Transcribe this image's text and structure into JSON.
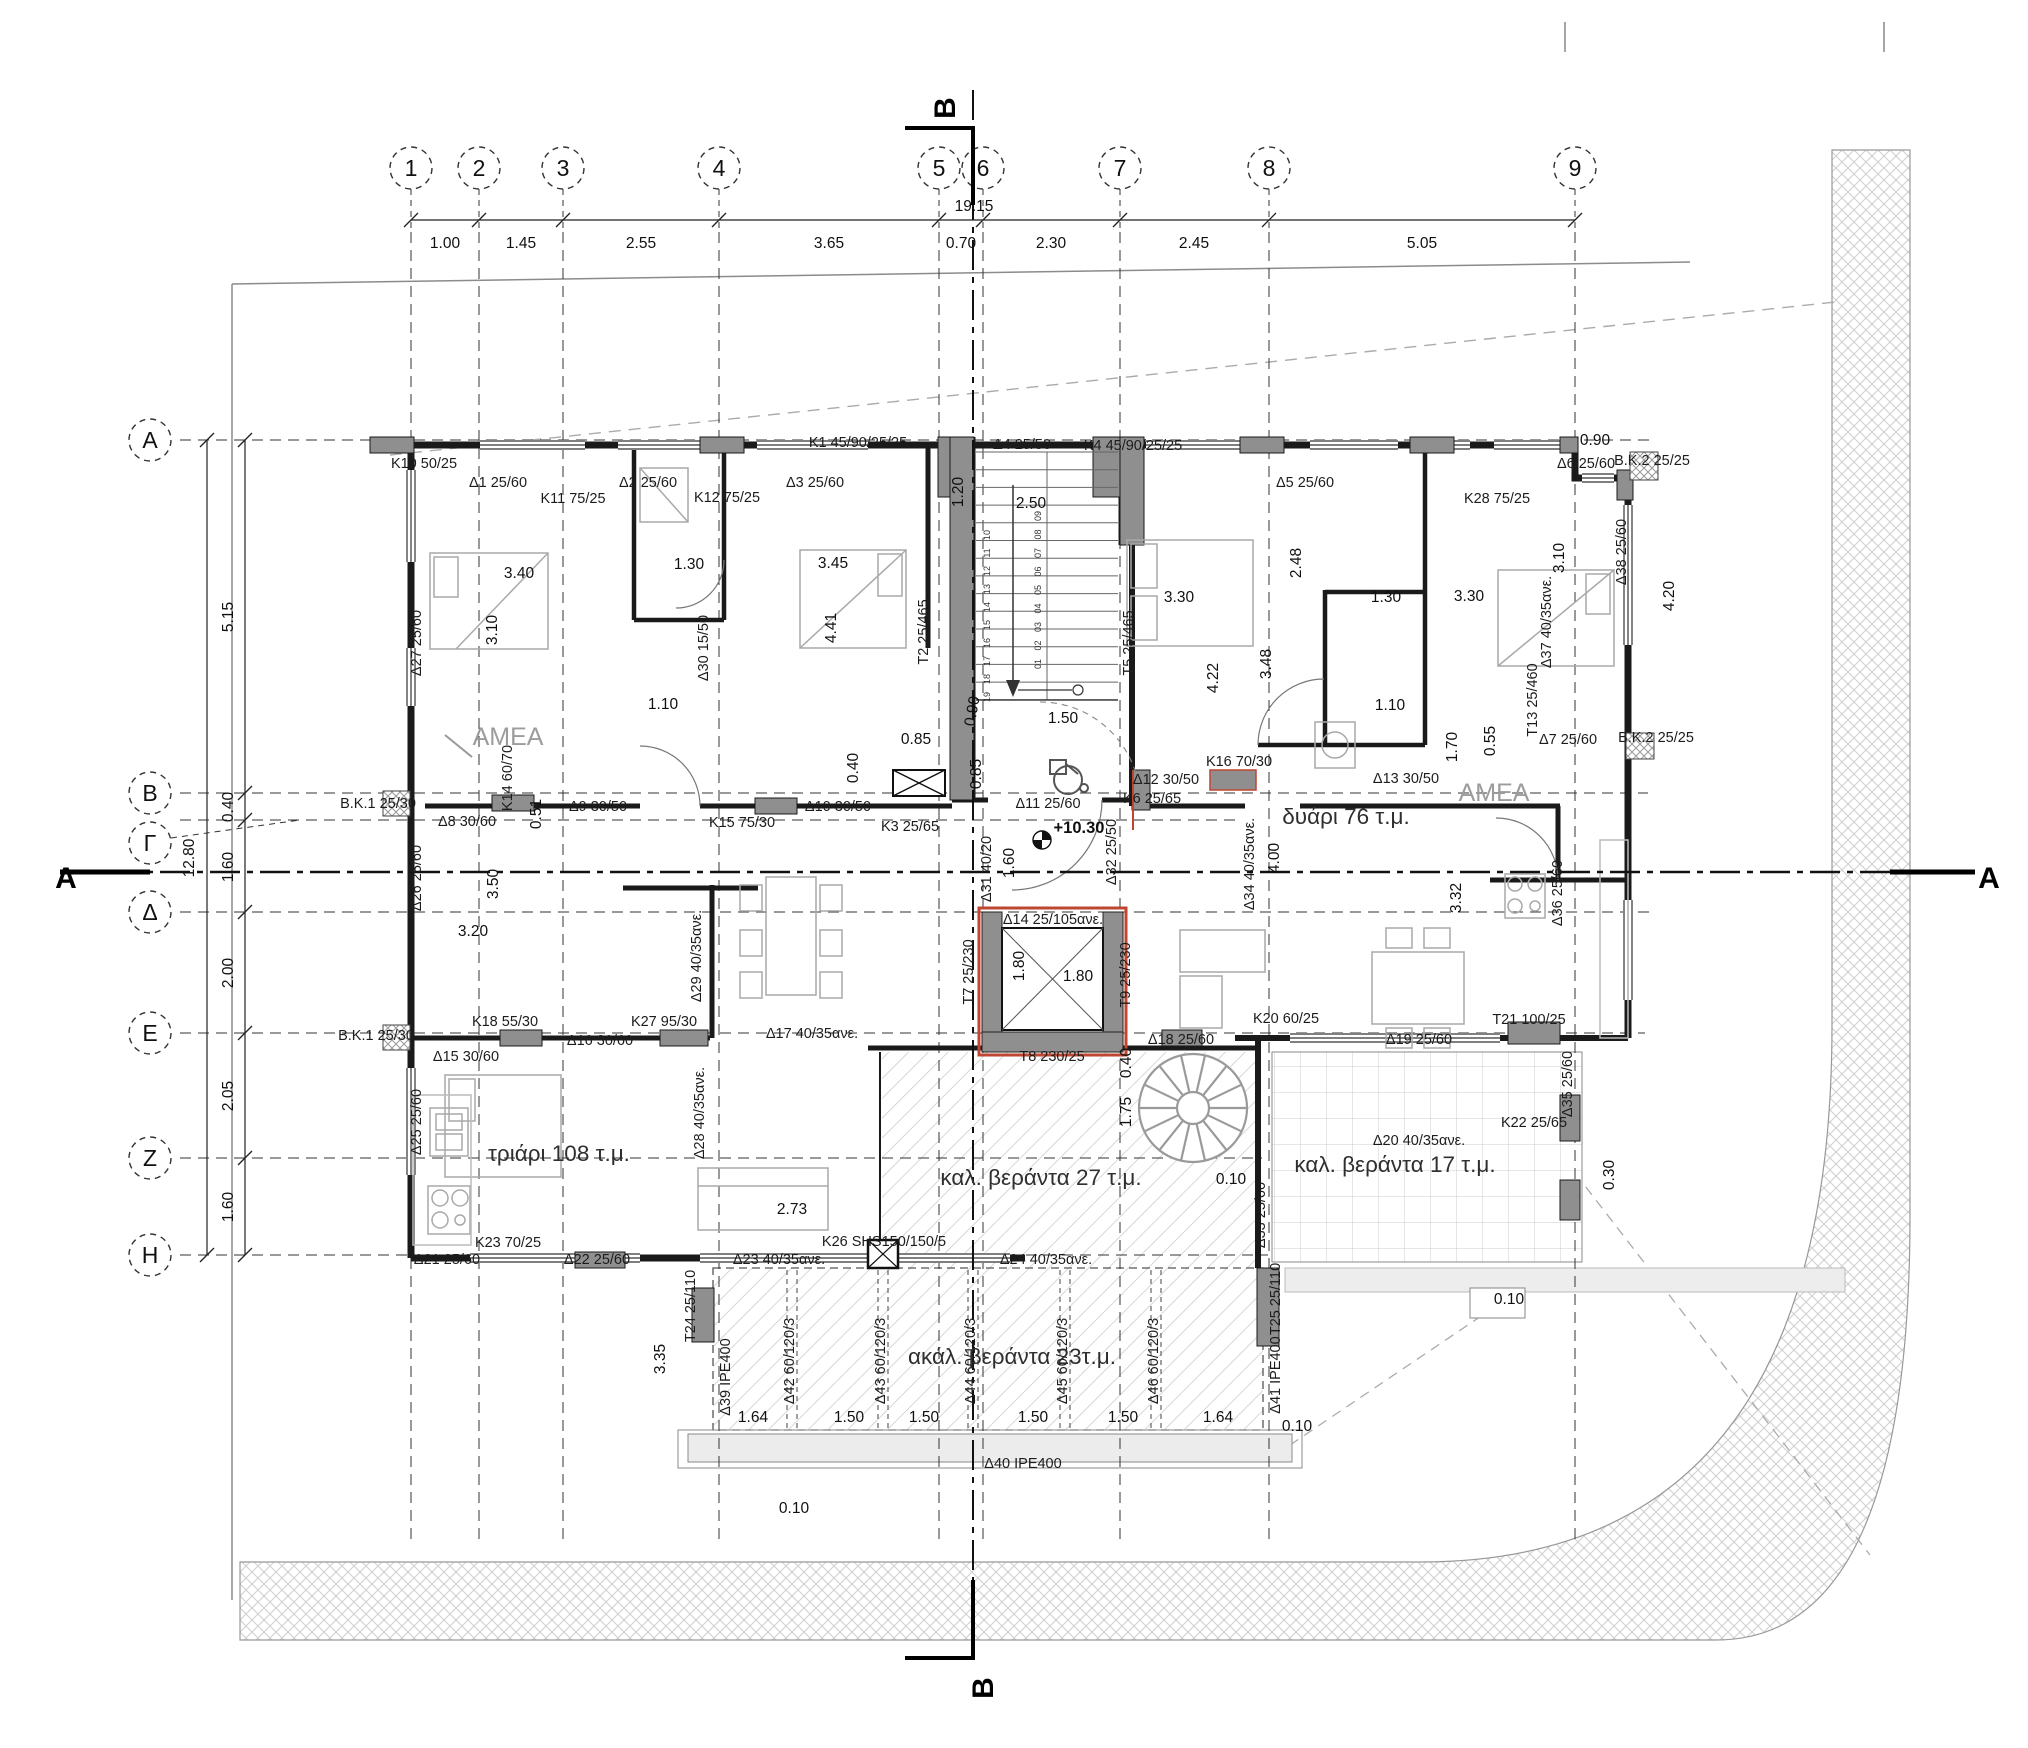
{
  "drawing": {
    "title": "Floor plan – apartment level",
    "level_elevation": "+10.30",
    "overall_width": "19.15",
    "overall_height": "12.80"
  },
  "colors": {
    "wall": "#1a1a1a",
    "column": "#8f8f8f",
    "accent_red": "#bf4630",
    "note_gray": "#9c9c9c",
    "hatch": "#c6c6c6"
  },
  "grid": {
    "columns": [
      [
        "1",
        411
      ],
      [
        "2",
        479
      ],
      [
        "3",
        563
      ],
      [
        "4",
        719
      ],
      [
        "5",
        939
      ],
      [
        "6",
        983
      ],
      [
        "7",
        1120
      ],
      [
        "8",
        1269
      ],
      [
        "9",
        1575
      ]
    ],
    "rows": [
      [
        "A",
        440
      ],
      [
        "B",
        793
      ],
      [
        "Γ",
        820
      ],
      [
        "Δ",
        912
      ],
      [
        "E",
        1033
      ],
      [
        "Z",
        1158
      ],
      [
        "H",
        1255
      ]
    ]
  },
  "stairs": {
    "left_numbers": [
      "10",
      "11",
      "12",
      "13",
      "14",
      "15",
      "16",
      "17",
      "18",
      "19"
    ],
    "right_numbers": [
      "09",
      "08",
      "07",
      "06",
      "05",
      "04",
      "03",
      "02",
      "01"
    ]
  },
  "labels": [
    [
      "K10 50/25",
      424,
      468,
      0,
      "b"
    ],
    [
      "Δ1 25/60",
      498,
      487,
      0,
      "b"
    ],
    [
      "K11 75/25",
      573,
      503,
      0,
      "b"
    ],
    [
      "Δ2 25/60",
      648,
      487,
      0,
      "b"
    ],
    [
      "K12 75/25",
      727,
      502,
      0,
      "b"
    ],
    [
      "Δ3 25/60",
      815,
      487,
      0,
      "b"
    ],
    [
      "K1 45/90/25/25",
      858,
      447,
      0,
      "b"
    ],
    [
      "Δ4 25/50",
      1022,
      449,
      0,
      "b"
    ],
    [
      "K4 45/90/25/25",
      1133,
      450,
      0,
      "b"
    ],
    [
      "Δ5 25/60",
      1305,
      487,
      0,
      "b"
    ],
    [
      "K28 75/25",
      1497,
      503,
      0,
      "b"
    ],
    [
      "Δ6 25/60",
      1586,
      468,
      0,
      "b"
    ],
    [
      "B.K.2 25/25",
      1652,
      465,
      0,
      "b"
    ],
    [
      "Δ27 25/60",
      421,
      643,
      -90,
      "b"
    ],
    [
      "Δ30 15/50",
      708,
      648,
      -90,
      "b"
    ],
    [
      "T2 25/465",
      928,
      632,
      -90,
      "b"
    ],
    [
      "T5 25/465",
      1133,
      643,
      -90,
      "b"
    ],
    [
      "Δ37 40/35ανε.",
      1551,
      622,
      -90,
      "b"
    ],
    [
      "Δ38 25/60",
      1626,
      552,
      -90,
      "b"
    ],
    [
      "B.K.1 25/30",
      378,
      808,
      0,
      "b"
    ],
    [
      "Δ8 30/60",
      467,
      826,
      0,
      "b"
    ],
    [
      "K14 60/70",
      512,
      778,
      -90,
      "b"
    ],
    [
      "Δ9 30/50",
      598,
      811,
      0,
      "b"
    ],
    [
      "K15 75/30",
      742,
      827,
      0,
      "b"
    ],
    [
      "Δ10 30/50",
      838,
      811,
      0,
      "b"
    ],
    [
      "K3 25/65",
      910,
      831,
      0,
      "b"
    ],
    [
      "Δ11 25/60",
      1048,
      808,
      0,
      "b"
    ],
    [
      "K6 25/65",
      1152,
      803,
      0,
      "b"
    ],
    [
      "Δ12 30/50",
      1166,
      784,
      0,
      "b"
    ],
    [
      "K16 70/30",
      1239,
      766,
      0,
      "b"
    ],
    [
      "Δ13 30/50",
      1406,
      783,
      0,
      "b"
    ],
    [
      "Δ7 25/60",
      1568,
      744,
      0,
      "b"
    ],
    [
      "B.K.2 25/25",
      1656,
      742,
      0,
      "b"
    ],
    [
      "T13 25/460",
      1537,
      700,
      -90,
      "b"
    ],
    [
      "Δ26 25/60",
      421,
      878,
      -90,
      "b"
    ],
    [
      "Δ32 25/50",
      1116,
      852,
      -90,
      "b"
    ],
    [
      "Δ31 40/20",
      991,
      869,
      -90,
      "b"
    ],
    [
      "Δ34 40/35ανε.",
      1254,
      864,
      -90,
      "b"
    ],
    [
      "Δ36 25/60",
      1562,
      893,
      -90,
      "b"
    ],
    [
      "Δ14 25/105ανε.",
      1053,
      924,
      0,
      "b"
    ],
    [
      "T7 25/230",
      973,
      972,
      -90,
      "b"
    ],
    [
      "T9 25/230",
      1130,
      975,
      -90,
      "b"
    ],
    [
      "T8 230/25",
      1052,
      1061,
      0,
      "b"
    ],
    [
      "Δ17 40/35ανε.",
      812,
      1038,
      0,
      "b"
    ],
    [
      "Δ29 40/35ανε.",
      701,
      956,
      -90,
      "b"
    ],
    [
      "B.K.1 25/30",
      376,
      1040,
      0,
      "b"
    ],
    [
      "K18 55/30",
      505,
      1026,
      0,
      "b"
    ],
    [
      "K27 95/30",
      664,
      1026,
      0,
      "b"
    ],
    [
      "Δ16 30/60",
      600,
      1045,
      0,
      "b"
    ],
    [
      "Δ15 30/60",
      466,
      1061,
      0,
      "b"
    ],
    [
      "Δ25 25/60",
      421,
      1122,
      -90,
      "b"
    ],
    [
      "Δ28 40/35ανε.",
      704,
      1113,
      -90,
      "b"
    ],
    [
      "K23 70/25",
      508,
      1247,
      0,
      "b"
    ],
    [
      "Δ21 25/60",
      447,
      1264,
      0,
      "b"
    ],
    [
      "Δ22 25/60",
      597,
      1264,
      0,
      "b"
    ],
    [
      "K26 SHS150/150/5",
      884,
      1246,
      0,
      "b"
    ],
    [
      "Δ23 40/35ανε.",
      779,
      1264,
      0,
      "b"
    ],
    [
      "Δ18 25/60",
      1181,
      1044,
      0,
      "b"
    ],
    [
      "K20 60/25",
      1286,
      1023,
      0,
      "b"
    ],
    [
      "Δ33 25/60",
      1265,
      1215,
      -90,
      "b"
    ],
    [
      "Δ19 25/60",
      1419,
      1044,
      0,
      "b"
    ],
    [
      "T21 100/25",
      1529,
      1024,
      0,
      "b"
    ],
    [
      "Δ35 25/60",
      1572,
      1084,
      -90,
      "b"
    ],
    [
      "K22 25/65",
      1534,
      1127,
      0,
      "b"
    ],
    [
      "Δ20 40/35ανε.",
      1419,
      1145,
      0,
      "b"
    ],
    [
      "T24 25/110",
      695,
      1306,
      -90,
      "b"
    ],
    [
      "Δ39 IPE400",
      730,
      1377,
      -90,
      "b"
    ],
    [
      "Δ42 60/120/3",
      794,
      1361,
      -90,
      "b"
    ],
    [
      "Δ43 60/120/3",
      885,
      1361,
      -90,
      "b"
    ],
    [
      "Δ44 60/120/3",
      975,
      1361,
      -90,
      "b"
    ],
    [
      "Δ45 60/120/3",
      1067,
      1361,
      -90,
      "b"
    ],
    [
      "Δ46 60/120/3",
      1158,
      1361,
      -90,
      "b"
    ],
    [
      "Δ41 IPE400",
      1280,
      1375,
      -90,
      "b"
    ],
    [
      "T25 25/110",
      1280,
      1299,
      -90,
      "b"
    ],
    [
      "Δ40 IPE400",
      1023,
      1468,
      0,
      "b"
    ],
    [
      "Δ24 40/35ανε.",
      1046,
      1264,
      0,
      "b"
    ],
    [
      "19.15",
      974,
      211,
      0,
      "d"
    ],
    [
      "1.00",
      445,
      248,
      0,
      "d"
    ],
    [
      "1.45",
      521,
      248,
      0,
      "d"
    ],
    [
      "2.55",
      641,
      248,
      0,
      "d"
    ],
    [
      "3.65",
      829,
      248,
      0,
      "d"
    ],
    [
      "0.70",
      961,
      248,
      0,
      "d"
    ],
    [
      "2.30",
      1051,
      248,
      0,
      "d"
    ],
    [
      "2.45",
      1194,
      248,
      0,
      "d"
    ],
    [
      "5.05",
      1422,
      248,
      0,
      "d"
    ],
    [
      "0.90",
      1595,
      445,
      0,
      "d"
    ],
    [
      "12.80",
      194,
      858,
      -90,
      "d"
    ],
    [
      "5.15",
      233,
      617,
      -90,
      "d"
    ],
    [
      "0.40",
      233,
      807,
      -90,
      "d"
    ],
    [
      "1.60",
      233,
      867,
      -90,
      "d"
    ],
    [
      "2.00",
      233,
      973,
      -90,
      "d"
    ],
    [
      "2.05",
      233,
      1096,
      -90,
      "d"
    ],
    [
      "1.60",
      233,
      1207,
      -90,
      "d"
    ],
    [
      "1.20",
      963,
      492,
      -90,
      "d"
    ],
    [
      "2.50",
      1031,
      508,
      0,
      "d"
    ],
    [
      "3.40",
      519,
      578,
      0,
      "d"
    ],
    [
      "3.10",
      497,
      630,
      -90,
      "d"
    ],
    [
      "1.30",
      689,
      569,
      0,
      "d"
    ],
    [
      "3.45",
      833,
      568,
      0,
      "d"
    ],
    [
      "4.41",
      836,
      628,
      -90,
      "d"
    ],
    [
      "3.30",
      1179,
      602,
      0,
      "d"
    ],
    [
      "2.48",
      1301,
      563,
      -90,
      "d"
    ],
    [
      "1.30",
      1386,
      602,
      0,
      "d"
    ],
    [
      "3.30",
      1469,
      601,
      0,
      "d"
    ],
    [
      "3.10",
      1564,
      558,
      -90,
      "d"
    ],
    [
      "4.20",
      1674,
      596,
      -90,
      "d"
    ],
    [
      "4.22",
      1218,
      678,
      -90,
      "d"
    ],
    [
      "3.48",
      1271,
      664,
      -90,
      "d"
    ],
    [
      "1.10",
      663,
      709,
      0,
      "d"
    ],
    [
      "0.51",
      541,
      814,
      -90,
      "d"
    ],
    [
      "3.50",
      498,
      884,
      -90,
      "d"
    ],
    [
      "3.20",
      473,
      936,
      0,
      "d"
    ],
    [
      "1.10",
      1390,
      710,
      0,
      "d"
    ],
    [
      "1.70",
      1457,
      747,
      -90,
      "d"
    ],
    [
      "0.55",
      1495,
      741,
      -90,
      "d"
    ],
    [
      "4.00",
      1279,
      858,
      -90,
      "d"
    ],
    [
      "3.32",
      1461,
      898,
      -90,
      "d"
    ],
    [
      "0.85",
      916,
      744,
      0,
      "d"
    ],
    [
      "0.40",
      858,
      768,
      -90,
      "d"
    ],
    [
      "0.85",
      981,
      774,
      -90,
      "d"
    ],
    [
      "0.90",
      977,
      712,
      -80,
      "d"
    ],
    [
      "1.50",
      1063,
      723,
      0,
      "d"
    ],
    [
      "1.60",
      1014,
      863,
      -90,
      "d"
    ],
    [
      "1.80",
      1024,
      966,
      -90,
      "d"
    ],
    [
      "1.80",
      1078,
      981,
      0,
      "d"
    ],
    [
      "2.73",
      792,
      1214,
      0,
      "d"
    ],
    [
      "0.40",
      1131,
      1063,
      -90,
      "d"
    ],
    [
      "1.75",
      1131,
      1112,
      -90,
      "d"
    ],
    [
      "0.10",
      1231,
      1184,
      0,
      "d"
    ],
    [
      "0.30",
      1614,
      1175,
      -90,
      "d"
    ],
    [
      "0.10",
      1509,
      1304,
      0,
      "d"
    ],
    [
      "1.64",
      753,
      1422,
      0,
      "d"
    ],
    [
      "1.50",
      849,
      1422,
      0,
      "d"
    ],
    [
      "1.50",
      924,
      1422,
      0,
      "d"
    ],
    [
      "1.50",
      1033,
      1422,
      0,
      "d"
    ],
    [
      "1.50",
      1123,
      1422,
      0,
      "d"
    ],
    [
      "1.64",
      1218,
      1422,
      0,
      "d"
    ],
    [
      "0.10",
      1297,
      1431,
      0,
      "d"
    ],
    [
      "0.10",
      794,
      1513,
      0,
      "d"
    ],
    [
      "3.35",
      665,
      1359,
      -90,
      "d"
    ],
    [
      "τριάρι 108 τ.μ.",
      559,
      1161,
      0,
      "r"
    ],
    [
      "δυάρι 76 τ.μ.",
      1346,
      824,
      0,
      "r"
    ],
    [
      "καλ. βεράντα 27 τ.μ.",
      1041,
      1185,
      0,
      "r"
    ],
    [
      "καλ. βεράντα 17 τ.μ.",
      1395,
      1172,
      0,
      "r"
    ],
    [
      "ακάλ. βεράντα 23τ.μ.",
      1012,
      1364,
      0,
      "r"
    ],
    [
      "ΑΜΕΑ",
      508,
      745,
      0,
      "n"
    ],
    [
      "ΑΜΕΑ",
      1494,
      801,
      0,
      "n"
    ],
    [
      "+10.30",
      1079,
      833,
      0,
      "e"
    ],
    [
      "B",
      955,
      108,
      -90,
      "s"
    ],
    [
      "B",
      993,
      1688,
      -90,
      "s"
    ],
    [
      "A",
      66,
      888,
      0,
      "s"
    ],
    [
      "A",
      1989,
      888,
      0,
      "s"
    ]
  ]
}
